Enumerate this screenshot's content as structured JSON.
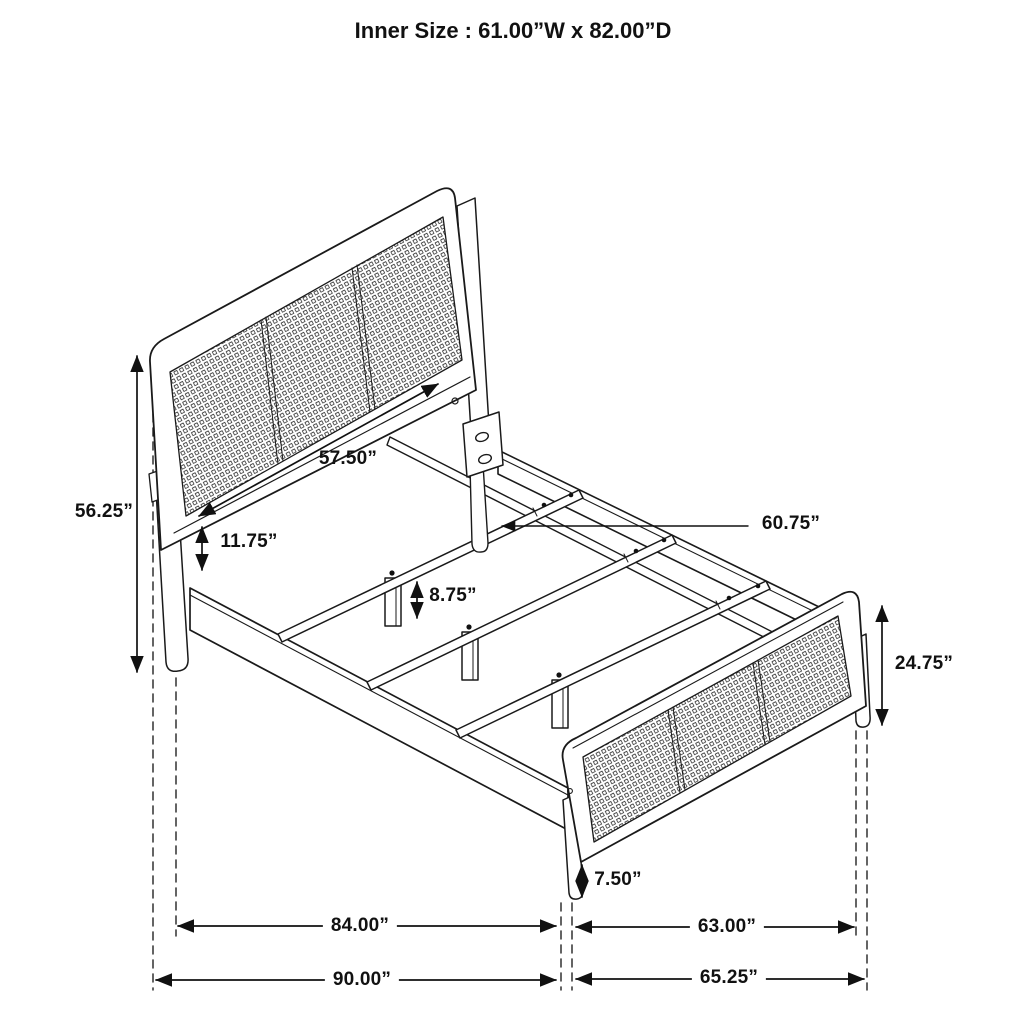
{
  "title": "Inner Size : 61.00”W x 82.00”D",
  "dimensions": {
    "headboard_height": "56.25”",
    "headboard_inner_width": "57.50”",
    "rail_to_headboard_gap": "11.75”",
    "slat_support_leg_height": "8.75”",
    "slat_length": "60.75”",
    "footboard_height": "24.75”",
    "footboard_leg_height": "7.50”",
    "frame_inner_length": "84.00”",
    "footboard_inner_width": "63.00”",
    "overall_length": "90.00”",
    "overall_width": "65.25”"
  },
  "colors": {
    "line": "#1a1a1a",
    "background": "#ffffff"
  }
}
